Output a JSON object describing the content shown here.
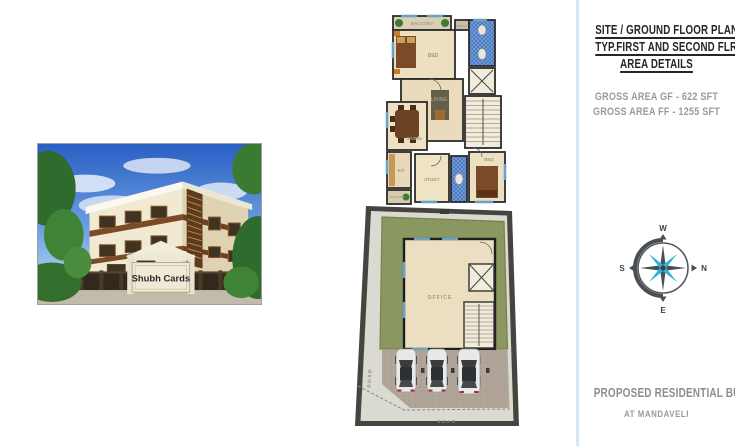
{
  "colors": {
    "divider": "#d9e7f2",
    "heading_text": "#262626",
    "muted_text": "#9a9a9a",
    "footer_text": "#8f8f8f",
    "compass_accent": "#2fb3d9",
    "compass_dark": "#4a4f54",
    "grass_green": "#8b9760",
    "toilet_tile_blue": "#4d7ec2",
    "plan_wall_dark": "#2b2b2b",
    "floor_cream": "#ecdfc2"
  },
  "photo": {
    "sign_label": "Shubh Cards"
  },
  "floor_plan": {
    "labels": {
      "balcony_top": "BALCONY",
      "bed1": "BED",
      "toilet_top": "TOILET",
      "living": "LIVING",
      "dining": "DINING",
      "kitchen": "KIT",
      "study": "STUDY",
      "bed2": "BED",
      "balcony_bottom": "BALCONY"
    }
  },
  "site_plan": {
    "labels": {
      "office": "OFFICE",
      "road_left": "ROAD",
      "road_bottom": "ROAD"
    }
  },
  "right_panel": {
    "headings": [
      "SITE / GROUND FLOOR PLAN",
      "TYP.FIRST AND SECOND FLR PLAN",
      "AREA DETAILS"
    ],
    "areas": [
      "GROSS AREA GF - 622 SFT",
      "GROSS AREA FF - 1255 SFT"
    ],
    "compass": {
      "top": "W",
      "right": "N",
      "bottom": "E",
      "left": "S"
    },
    "footer": [
      "PROPOSED RESIDENTIAL BUILDIN",
      "AT MANDAVELI"
    ]
  }
}
